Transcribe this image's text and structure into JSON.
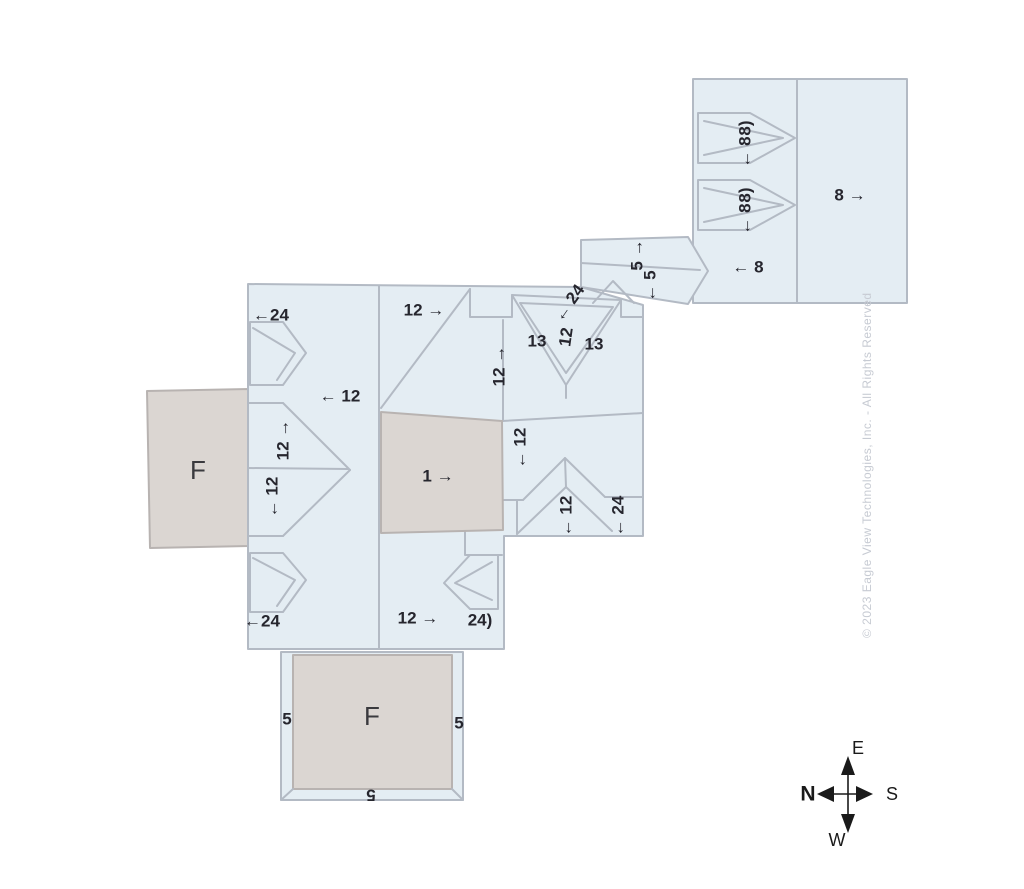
{
  "diagram": {
    "kind": "roof-pitch-diagram",
    "background": "#ffffff"
  },
  "colors": {
    "roof_fill": "#e4edf3",
    "roof_line": "#b3bac4",
    "flat_fill": "#dbd6d2",
    "flat_line": "#b8b3b1",
    "label_text": "#26262e",
    "watermark_text": "#c7cbd3",
    "compass_text": "#1a1a1a"
  },
  "watermark": "© 2023 Eagle View Technologies, Inc. - All Rights Reserved",
  "compass": {
    "top": "E",
    "right": "S",
    "bottom": "W",
    "left": "N"
  },
  "annotations": [
    {
      "text": "←24",
      "x": 271,
      "y": 315
    },
    {
      "text": "← 12",
      "x": 340,
      "y": 396
    },
    {
      "text": "12 →",
      "x": 283,
      "y": 440,
      "rot": -90
    },
    {
      "text": "← 12",
      "x": 272,
      "y": 497,
      "rot": -90
    },
    {
      "text": "←24",
      "x": 262,
      "y": 621
    },
    {
      "text": "12 →",
      "x": 424,
      "y": 310
    },
    {
      "text": "12 →",
      "x": 499,
      "y": 366,
      "rot": -90
    },
    {
      "text": "← 24",
      "x": 569,
      "y": 303,
      "rot": -55
    },
    {
      "text": "12",
      "x": 566,
      "y": 337,
      "rot": -82
    },
    {
      "text": "13",
      "x": 537,
      "y": 341
    },
    {
      "text": "13",
      "x": 594,
      "y": 344
    },
    {
      "text": "1 →",
      "x": 438,
      "y": 476
    },
    {
      "text": "← 12",
      "x": 520,
      "y": 448,
      "rot": -90
    },
    {
      "text": "← 12",
      "x": 566,
      "y": 516,
      "rot": -90
    },
    {
      "text": "← 24",
      "x": 618,
      "y": 516,
      "rot": -90
    },
    {
      "text": "12 →",
      "x": 418,
      "y": 618
    },
    {
      "text": "24)",
      "x": 480,
      "y": 620
    },
    {
      "text": "5 →",
      "x": 637,
      "y": 255,
      "rot": -90
    },
    {
      "text": "← 5",
      "x": 650,
      "y": 286,
      "rot": -90
    },
    {
      "text": "← 8",
      "x": 748,
      "y": 267
    },
    {
      "text": "8 →",
      "x": 850,
      "y": 195
    },
    {
      "text": "8)",
      "x": 745,
      "y": 128,
      "rot": -90
    },
    {
      "text": "← 8",
      "x": 745,
      "y": 152,
      "rot": -90
    },
    {
      "text": "8)",
      "x": 745,
      "y": 195,
      "rot": -90
    },
    {
      "text": "← 8",
      "x": 745,
      "y": 219,
      "rot": -90
    },
    {
      "text": "5",
      "x": 287,
      "y": 719
    },
    {
      "text": "5",
      "x": 459,
      "y": 723
    },
    {
      "text": "5",
      "x": 371,
      "y": 795,
      "rot": 180
    },
    {
      "text": "F",
      "x": 198,
      "y": 470,
      "cls": "flat-label"
    },
    {
      "text": "F",
      "x": 372,
      "y": 716,
      "cls": "flat-label"
    }
  ]
}
